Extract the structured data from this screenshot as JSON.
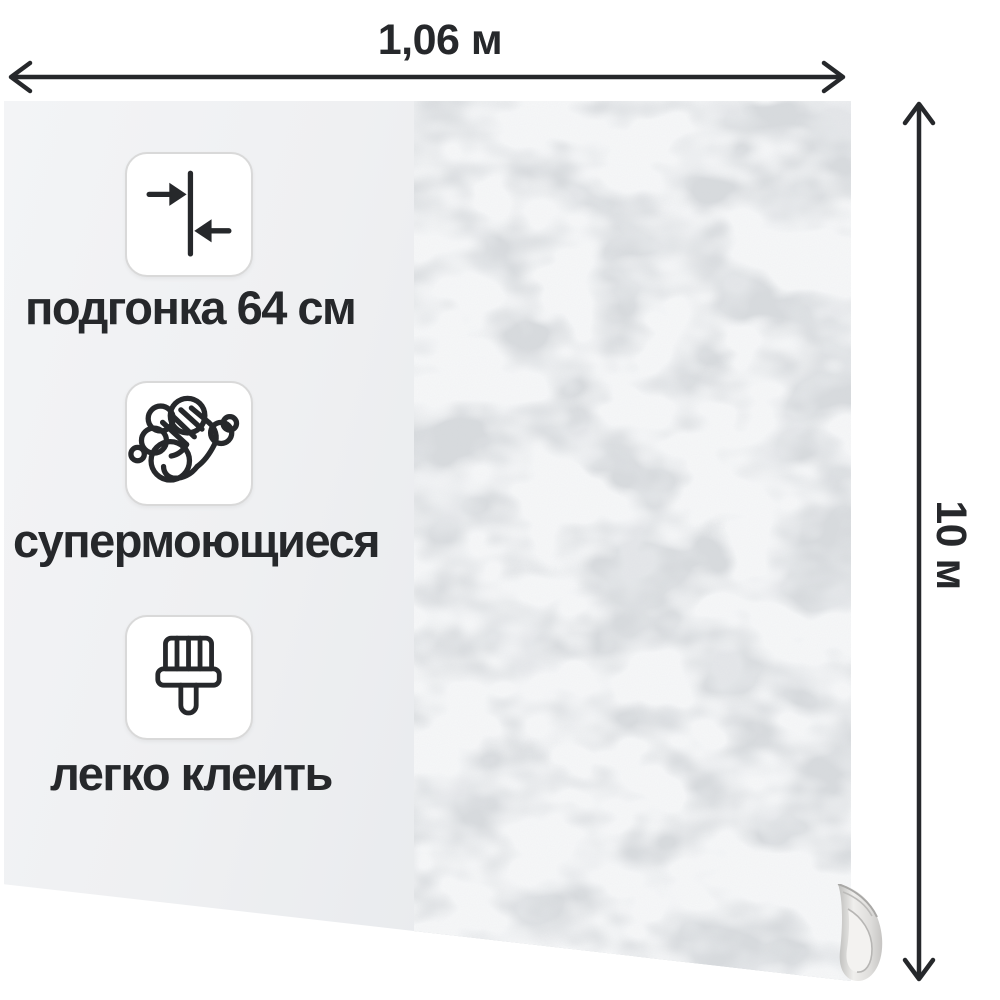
{
  "canvas": {
    "background": "#ffffff"
  },
  "dimensions": {
    "width_label": "1,06 м",
    "height_label": "10 м"
  },
  "features": [
    {
      "icon": "pattern-match-offset-icon",
      "label": "подгонка 64 см"
    },
    {
      "icon": "washable-hand-bubbles-icon",
      "label": "супермоющиеся"
    },
    {
      "icon": "glue-brush-icon",
      "label": "легко клеить"
    }
  ],
  "wallpaper": {
    "back_side_color": "#f0f1f3",
    "textured_side_color": "#d8dbde",
    "texture_style": "plaster",
    "rolled_corner": "bottom-right"
  },
  "ink_color": "#26282b",
  "card": {
    "background": "#ffffff",
    "border_color": "#d9d9d9"
  }
}
